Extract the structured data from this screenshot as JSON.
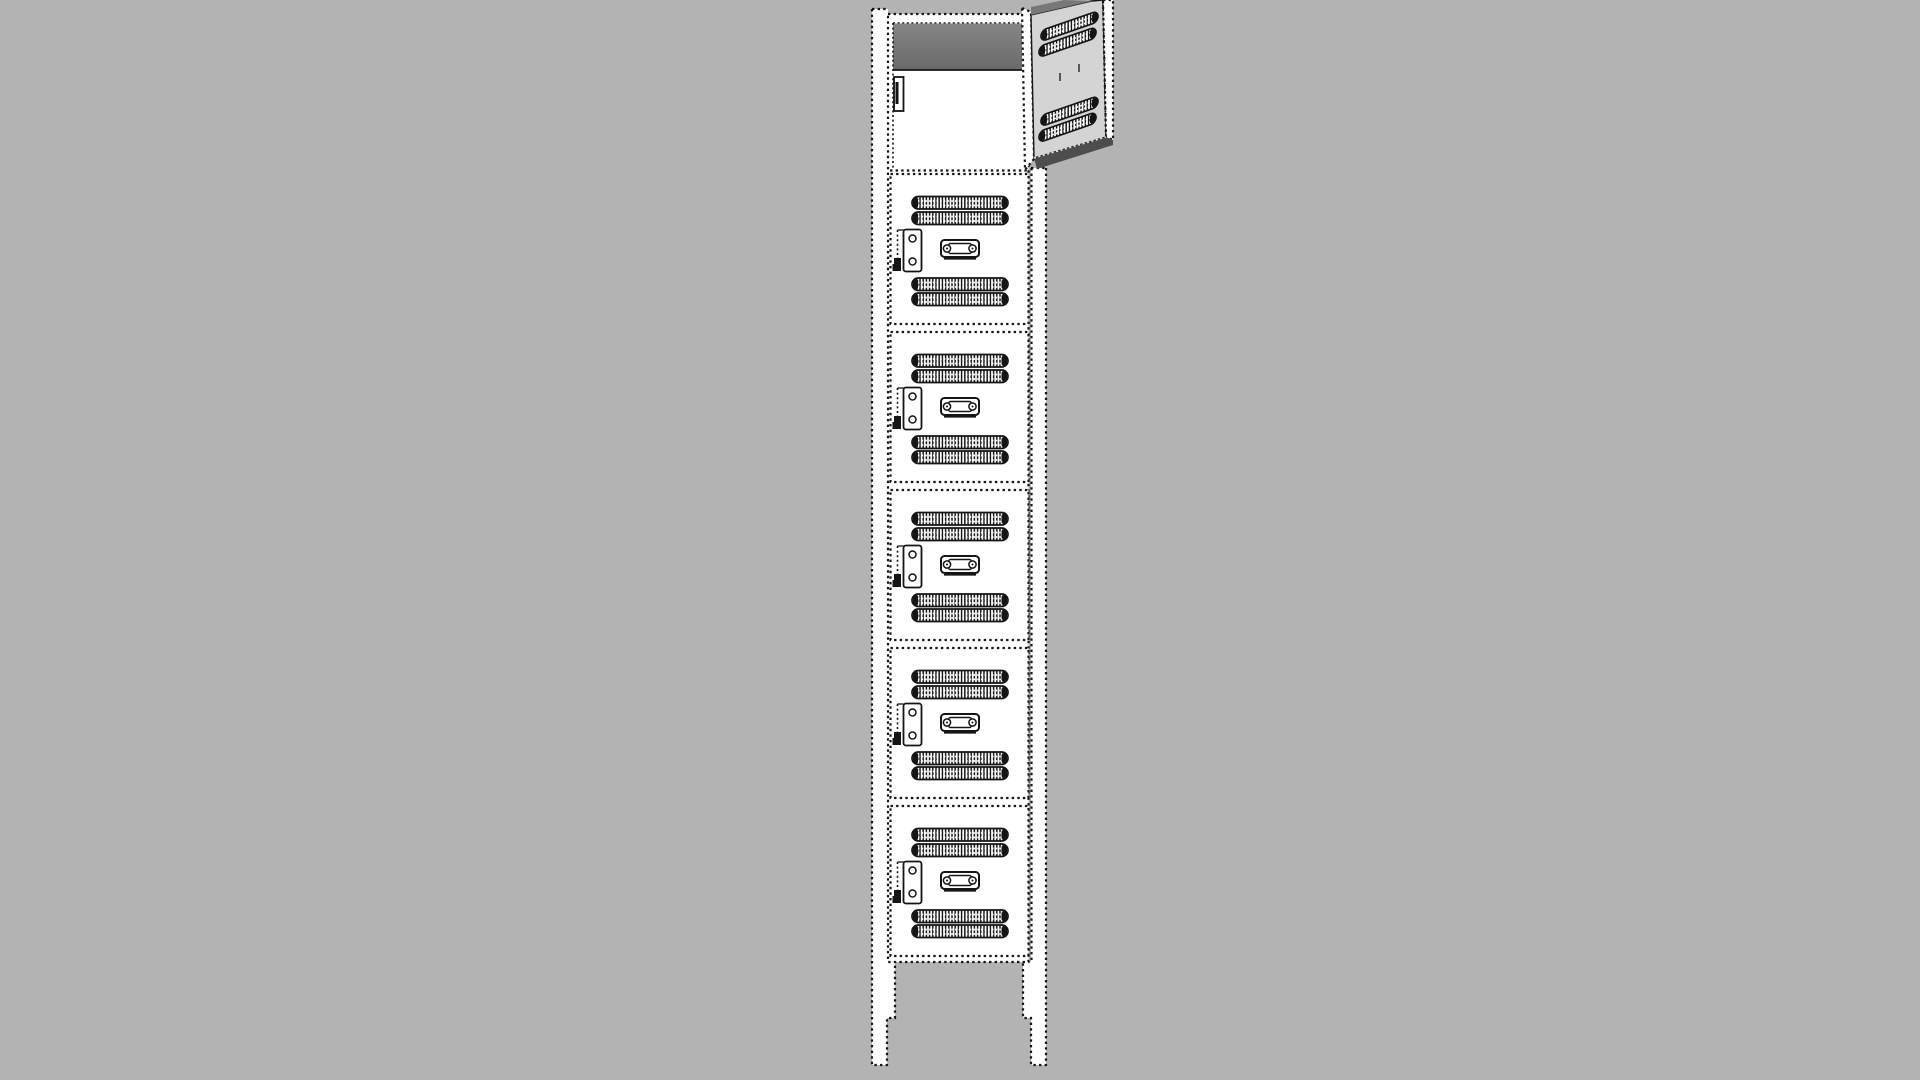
{
  "viewport": {
    "kind": "3d-model-view",
    "object": "single-column six-tier locker drawn in sketchy stippled line style",
    "background_color": "#b3b3b3"
  },
  "colors": {
    "background": "#b3b3b3",
    "surface_white": "#ffffff",
    "line": "#151515",
    "open_door_face": "#d4d4d4",
    "door_top_edge": "#787878",
    "door_bottom_edge": "#4d4d4d",
    "interior_shadow_top": "#858585",
    "interior_shadow_bottom": "#6a6a6a"
  },
  "locker": {
    "tiers_total": 6,
    "open_compartments": 1,
    "closed_doors_count": 5,
    "legs_count": 2,
    "compartments": [
      {
        "tier": 1,
        "state": "open",
        "door": "swung open to the right, two vent pairs on inner face"
      },
      {
        "tier": 2,
        "state": "closed"
      },
      {
        "tier": 3,
        "state": "closed"
      },
      {
        "tier": 4,
        "state": "closed"
      },
      {
        "tier": 5,
        "state": "closed"
      },
      {
        "tier": 6,
        "state": "closed"
      }
    ],
    "features_per_closed_door": [
      "upper-vent-pair",
      "latch-plate-left",
      "handle-plate-center",
      "lower-vent-pair"
    ],
    "closed_door": {
      "x": 890.5,
      "width": 138,
      "height": 150,
      "tops_y": [
        174,
        332,
        490,
        648,
        806
      ],
      "vent": {
        "x": 912,
        "width": 96,
        "height": 12.5,
        "y_offsets": [
          22.5,
          38,
          104,
          119
        ]
      },
      "latch": {
        "plate_x": 903.5,
        "plate_width": 18,
        "plate_height": 42,
        "plate_y_offset": 55.5,
        "screw_y_offsets": [
          64.5,
          87.5
        ]
      },
      "handle": {
        "x": 941,
        "width": 38,
        "height": 17,
        "y_offset": 66
      }
    },
    "open_door_vent_slats": {
      "skew_deg": -19,
      "width": 57,
      "height": 11,
      "positions": [
        {
          "x": 1041,
          "y": 30.5
        },
        {
          "x": 1039,
          "y": 46.5
        },
        {
          "x": 1041,
          "y": 115.5
        },
        {
          "x": 1039,
          "y": 131.5
        }
      ]
    }
  }
}
